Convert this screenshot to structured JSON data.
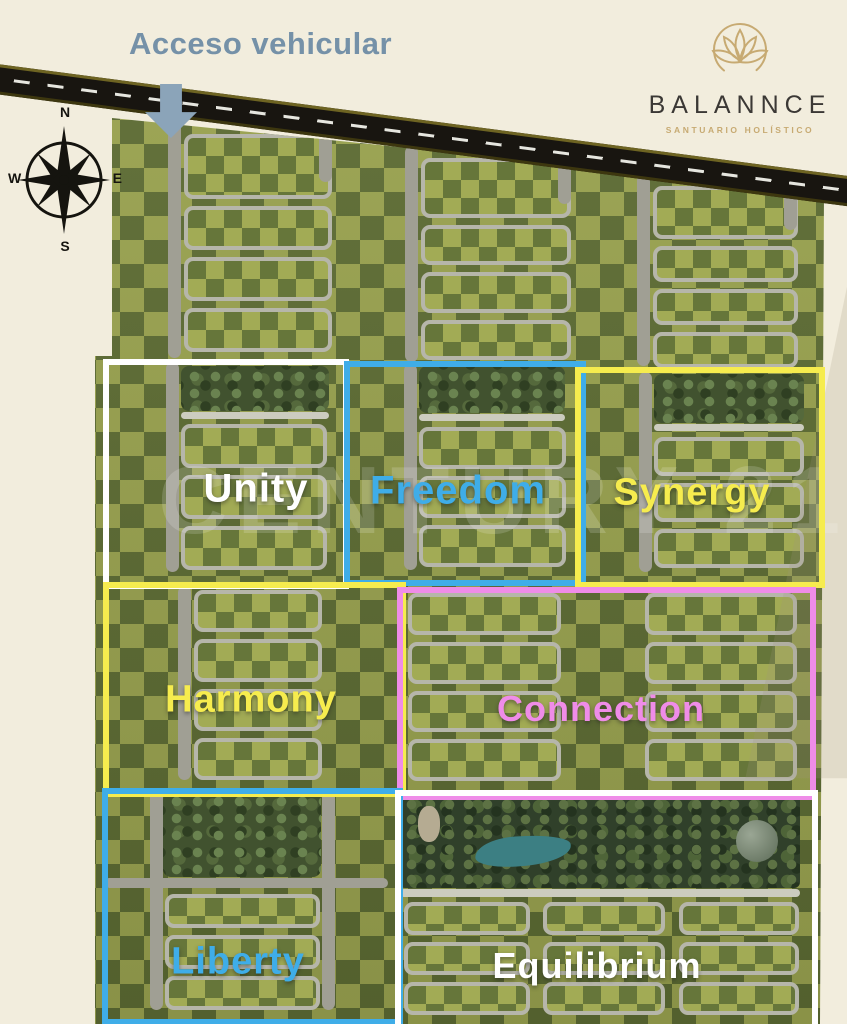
{
  "access": {
    "label": "Acceso vehicular",
    "color": "#7591a8",
    "arrow_color": "#8ba4b9"
  },
  "logo": {
    "brand": "BALANNCE",
    "tagline": "SANTUARIO HOLÍSTICO",
    "gold": "#c7aa72",
    "ink": "#3b3835"
  },
  "compass": {
    "n": "N",
    "e": "E",
    "s": "S",
    "w": "W"
  },
  "watermark": {
    "text": "CENTURY 21"
  },
  "sections": [
    {
      "id": "unity",
      "label": "Unity",
      "color": "#ffffff"
    },
    {
      "id": "freedom",
      "label": "Freedom",
      "color": "#3fade8"
    },
    {
      "id": "synergy",
      "label": "Synergy",
      "color": "#f6ec4e"
    },
    {
      "id": "harmony",
      "label": "Harmony",
      "color": "#f6ec4e"
    },
    {
      "id": "connection",
      "label": "Connection",
      "color": "#ef8ce8"
    },
    {
      "id": "liberty",
      "label": "Liberty",
      "color": "#3fade8"
    },
    {
      "id": "equilibrium",
      "label": "Equilibrium",
      "color": "#ffffff"
    }
  ]
}
